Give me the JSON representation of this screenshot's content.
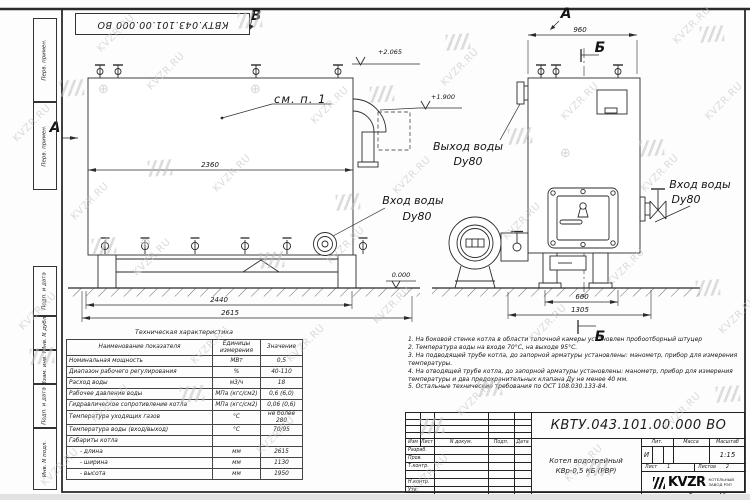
{
  "doc": {
    "number": "КВТУ.043.101.00.000 ВО",
    "format_label": "Формат",
    "format_value": "А3"
  },
  "margin": {
    "labels": [
      "Перв. примен.",
      "Перв. примен.",
      "Подп. и дата",
      "Инв. N дубл.",
      "Взам. инв. N",
      "Подп. и дата",
      "Инв. N подл."
    ]
  },
  "views": {
    "view_b": "В",
    "view_a_top": "А",
    "view_a_left": "А",
    "section_b_top": "Б",
    "section_b_bottom": "Б",
    "callout": "см. п. 1",
    "elev_top": "+2.065",
    "elev_mid": "+1.900",
    "elev_zero": "0.000",
    "dim_2360": "2360",
    "dim_2440": "2440",
    "dim_2615": "2615",
    "dim_960": "960",
    "dim_660": "660",
    "dim_1305": "1305",
    "outlet_label": "Выход воды",
    "outlet_dn": "Dy80",
    "inlet_label": "Вход воды",
    "inlet_dn": "Dy80",
    "inlet_right_label": "Вход воды",
    "inlet_right_dn": "Dy80"
  },
  "spec_table": {
    "title": "Техническая характеристика",
    "headers": {
      "name": "Наименование показателя",
      "units": "Единицы измерения",
      "value": "Значение"
    },
    "rows": [
      {
        "name": "Номинальная мощность",
        "units": "МВт",
        "value": "0,5"
      },
      {
        "name": "Диапазон рабочего регулирования",
        "units": "%",
        "value": "40-110"
      },
      {
        "name": "Расход воды",
        "units": "м3/ч",
        "value": "18"
      },
      {
        "name": "Рабочее давление воды",
        "units": "МПа (кгс/см2)",
        "value": "0,6 (6,0)"
      },
      {
        "name": "Гидравлическое сопротивление котла",
        "units": "МПа (кгс/см2)",
        "value": "0,06 (0,6)"
      },
      {
        "name": "Температура уходящих газов",
        "units": "°С",
        "value": "не более 280"
      },
      {
        "name": "Температура воды (вход/выход)",
        "units": "°С",
        "value": "70/95"
      },
      {
        "name": "Габариты котла",
        "units": "",
        "value": ""
      },
      {
        "name": "- длина",
        "units": "мм",
        "value": "2615"
      },
      {
        "name": "- ширина",
        "units": "мм",
        "value": "1130"
      },
      {
        "name": "- высота",
        "units": "мм",
        "value": "1950"
      }
    ]
  },
  "notes": [
    "1. На боковой стенке котла в области топочной камеры установлен пробоотборный штуцер",
    "2. Температура воды на входе 70°С, на выходе 95°С.",
    "3. На подводящей трубе котла, до запорной арматуры установлены: манометр, прибор для измерения температуры.",
    "4. На отводящей трубе котла, до запорной арматуры установлены: манометр, прибор для измерения температуры и два предохранительных клапана Ду не менее 40 мм.",
    "5. Остальные технические требования по ОСТ 108.030.133-84."
  ],
  "title_block": {
    "doc_number": "КВТУ.043.101.00.000 ВО",
    "product_line1": "Котел водогрейный",
    "product_line2": "КВр-0,5 КБ (РВР)",
    "header_izm": "Изм",
    "header_list": "Лист",
    "header_ndoc": "N докум.",
    "header_podp": "Подп.",
    "header_data": "Дата",
    "row_labels": [
      "Разраб.",
      "Пров.",
      "Т.контр.",
      "",
      "Н.контр.",
      "Утв."
    ],
    "lit_header": "Лит.",
    "mass_header": "Масса",
    "scale_header": "Масштаб",
    "lit_value": "И",
    "scale_value": "1:15",
    "sheet_label": "Лист",
    "sheet_value": "1",
    "sheets_label": "Листов",
    "sheets_value": "2",
    "company_logo": "KVZR",
    "company_line1": "КОТЕЛЬНЫЙ",
    "company_line2": "ЗАВОД РЭП"
  },
  "watermark": {
    "text": "KVZR.RU"
  }
}
